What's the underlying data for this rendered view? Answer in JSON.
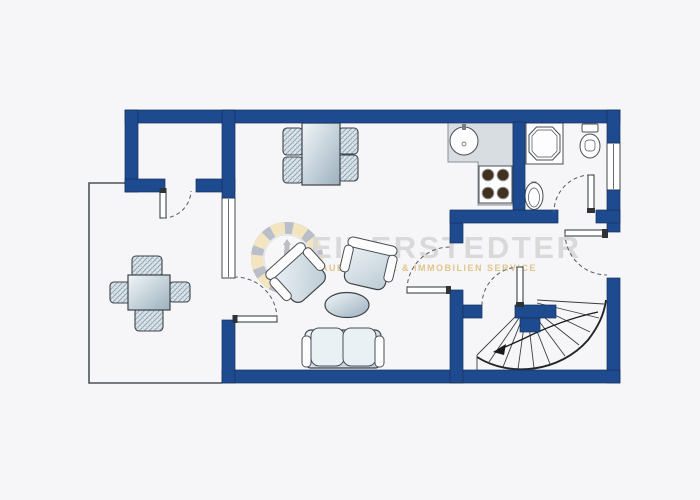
{
  "watermark": {
    "title": "EIDERSTEDTER",
    "subtitle": "BAUELEMENTE & IMMOBILIEN SERVICE"
  },
  "colors": {
    "background": "#f6f6f8",
    "wall": "#1e4a8f",
    "wall_outline": "#16315c",
    "door_swing_line": "#5c6269",
    "furniture_outline": "#3d4349",
    "counter": "#d8dde1",
    "burner": "#43301e",
    "stair_line": "#2a2d30",
    "terrace_outline": "#4d5358",
    "watermark_text": "#d9d9da",
    "watermark_accent": "#e2c489",
    "logo_gold": "#eec043",
    "logo_navy": "#31415c"
  },
  "floorplan": {
    "type": "apartment-floor-plan",
    "symbols": [
      {
        "name": "dining-table-4-chairs",
        "location": "top-center"
      },
      {
        "name": "patio-table-4-chairs",
        "location": "terrace-left"
      },
      {
        "name": "armchair",
        "count": 2,
        "location": "living-room"
      },
      {
        "name": "coffee-table-oval",
        "location": "living-room"
      },
      {
        "name": "two-seat-sofa",
        "location": "living-room"
      },
      {
        "name": "kitchen-counter-l-shape",
        "location": "kitchen"
      },
      {
        "name": "kitchen-sink-round",
        "location": "kitchen"
      },
      {
        "name": "stove-4-burners",
        "location": "kitchen"
      },
      {
        "name": "shower-octagon",
        "location": "bathroom"
      },
      {
        "name": "washbasin-oval",
        "location": "bathroom"
      },
      {
        "name": "toilet",
        "location": "bathroom"
      },
      {
        "name": "winder-staircase",
        "location": "bottom-right"
      },
      {
        "name": "window",
        "count": 2
      },
      {
        "name": "door-swing",
        "count": 6
      },
      {
        "name": "terrace-thin-outline",
        "location": "left"
      }
    ]
  }
}
